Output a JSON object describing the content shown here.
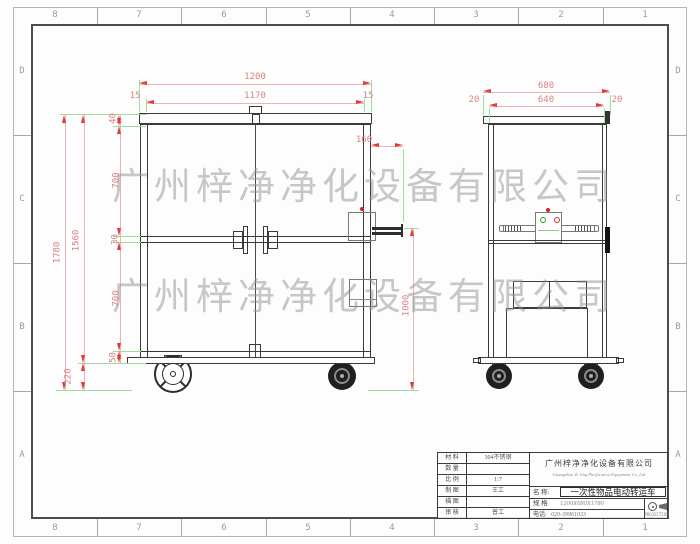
{
  "sheet": {
    "zones_top": [
      "8",
      "7",
      "6",
      "5",
      "4",
      "3",
      "2",
      "1"
    ],
    "zones_bottom": [
      "8",
      "7",
      "6",
      "5",
      "4",
      "3",
      "2",
      "1"
    ],
    "zones_left": [
      "D",
      "C",
      "B",
      "A"
    ],
    "zones_right": [
      "D",
      "C",
      "B",
      "A"
    ]
  },
  "watermark": {
    "line1": "广州梓净净化设备有限公司",
    "line2": "广州梓净净化设备有限公司"
  },
  "dims": {
    "front_overall_width": "1200",
    "front_inner_width": "1170",
    "front_side_left": "15",
    "front_side_right": "15",
    "front_overall_height": "1780",
    "front_body_height": "1560",
    "front_wheel_height": "220",
    "front_top_cap": "40",
    "front_upper_door": "700",
    "front_mid_rail": "30",
    "front_lower_door": "700",
    "front_bottom_rail": "50",
    "front_handle_length": "160",
    "front_handle_height": "1000",
    "side_overall_width": "680",
    "side_inner_width": "640",
    "side_margin_left": "20",
    "side_margin_right": "20"
  },
  "title_block": {
    "material_label": "材 料",
    "material_value": "304不锈钢",
    "quantity_label": "数 量",
    "quantity_value": "",
    "scale_label": "比 例",
    "scale_value": "1:7",
    "drawn_label": "制 图",
    "drawn_value": "王工",
    "traced_label": "描 图",
    "traced_value": "",
    "checked_label": "审 核",
    "checked_value": "普工",
    "company_cn": "广州梓净净化设备有限公司",
    "company_en": "Guangzhou Zi Jing Purification Equipment Co.,Ltd",
    "name_label": "名 称:",
    "name_value": "一次性物品电动转运车",
    "spec_label": "规 格",
    "spec_value": "1200X680X1780",
    "phone_label": "电话:",
    "phone_value": "020-39961033",
    "projection_label": "PROJECTION"
  },
  "colors": {
    "dim_arrow_red": "#e03a3a",
    "dim_text_red": "#db8282",
    "ext_green": "#9bdf9b",
    "line_dark": "#3a3a3a",
    "watermark_gray": "#919191"
  }
}
